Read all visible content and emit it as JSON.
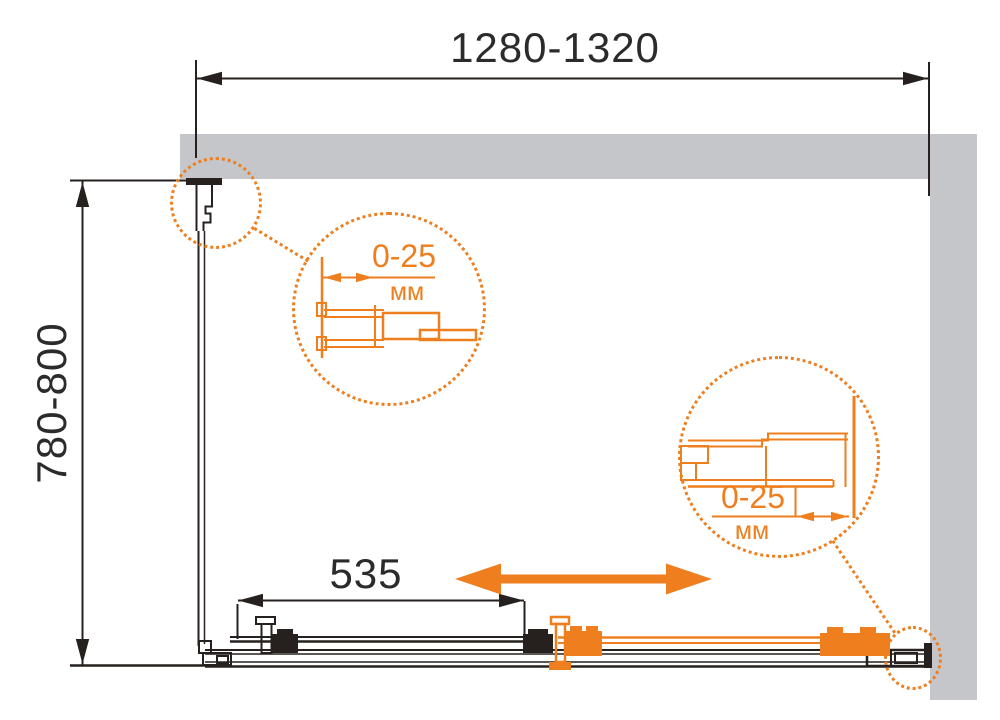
{
  "colors": {
    "accent": "#EE7E1E",
    "wall": "#C4C6CA",
    "line": "#26211E",
    "text": "#2B2B2B"
  },
  "dimensions": {
    "overall_width": "1280-1320",
    "overall_depth": "780-800",
    "door_panel_width": "535"
  },
  "details": {
    "left": {
      "range": "0-25",
      "unit": "мм"
    },
    "right": {
      "range": "0-25",
      "unit": "мм"
    }
  }
}
